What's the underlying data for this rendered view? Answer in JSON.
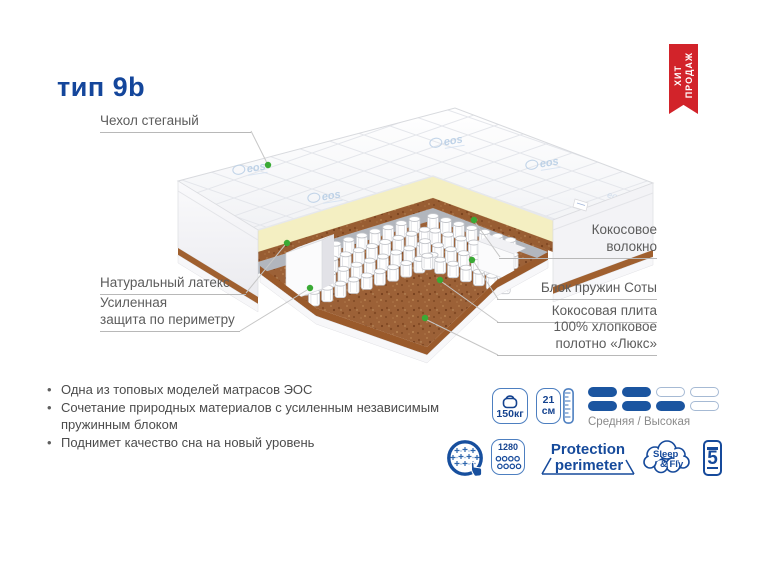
{
  "title": "тип 9b",
  "badge": {
    "line1": "ХИТ",
    "line2": "ПРОДАЖ"
  },
  "diagram": {
    "watermark": "eos",
    "labels": {
      "cover": "Чехол стеганый",
      "latex": "Натуральный латекс",
      "perimeter_l1": "Усиленная",
      "perimeter_l2": "защита по периметру",
      "fiber_l1": "Кокосовое",
      "fiber_l2": "волокно",
      "springs": "Блок пружин Соты",
      "plate": "Кокосовая плита",
      "cotton_l1": "100% хлопковое",
      "cotton_l2": "полотно «Люкс»"
    }
  },
  "bullets": [
    "Одна из топовых моделей матрасов ЭОС",
    "Сочетание природных материалов с усиленным независимым пружинным блоком",
    "Поднимет качество сна на новый уровень"
  ],
  "features": {
    "weight": {
      "value": "150кг"
    },
    "height": {
      "value": "21",
      "unit": "см"
    },
    "firmness": {
      "rows": [
        [
          1,
          1,
          0,
          0
        ],
        [
          1,
          1,
          1,
          0
        ]
      ],
      "label": "Средняя / Высокая"
    },
    "spring_count": {
      "value": "1280"
    },
    "protection": {
      "line1": "Protection",
      "line2": "perimeter"
    },
    "brand": {
      "line1": "Sleep",
      "line2": "& Fly"
    },
    "warranty": {
      "value": "5"
    }
  },
  "colors": {
    "accent_blue": "#14469b",
    "icon_blue": "#164a9b",
    "badge_red": "#d2232a",
    "dot_green": "#3aaa35",
    "coir_brown": "#a5673a",
    "latex_cream": "#f4efc2"
  }
}
